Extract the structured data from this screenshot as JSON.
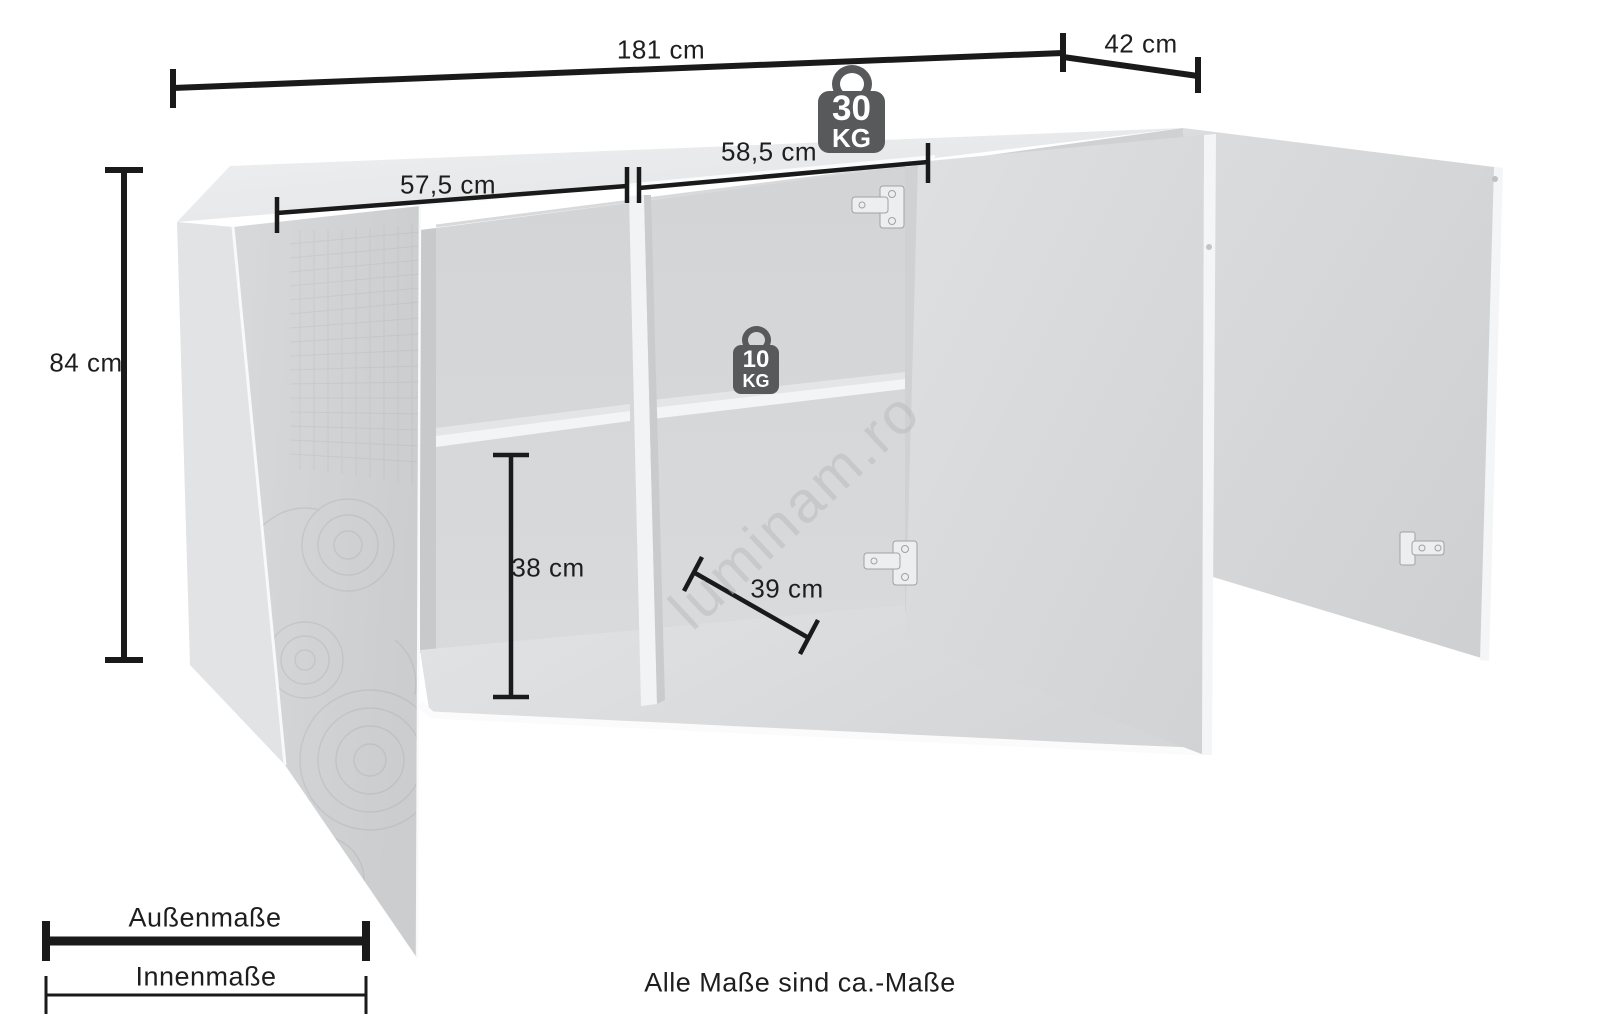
{
  "diagram": {
    "dimensions": {
      "total_width": "181 cm",
      "total_depth": "42 cm",
      "total_height": "84 cm",
      "compartment_left_width": "57,5 cm",
      "compartment_right_width": "58,5 cm",
      "compartment_lower_height": "38 cm",
      "compartment_depth": "39 cm"
    },
    "load_capacity": {
      "top": {
        "value": "30",
        "unit": "KG"
      },
      "shelf": {
        "value": "10",
        "unit": "KG"
      }
    },
    "legend": {
      "outer_label": "Außenmaße",
      "inner_label": "Innenmaße"
    },
    "footnote": "Alle Maße sind ca.-Maße",
    "watermark": "luminam.ro",
    "colors": {
      "dimension_line": "#1a1a1a",
      "weight_badge": "#58595b",
      "cabinet_light": "#e8e9ea",
      "cabinet_mid": "#d5d7d9"
    }
  }
}
